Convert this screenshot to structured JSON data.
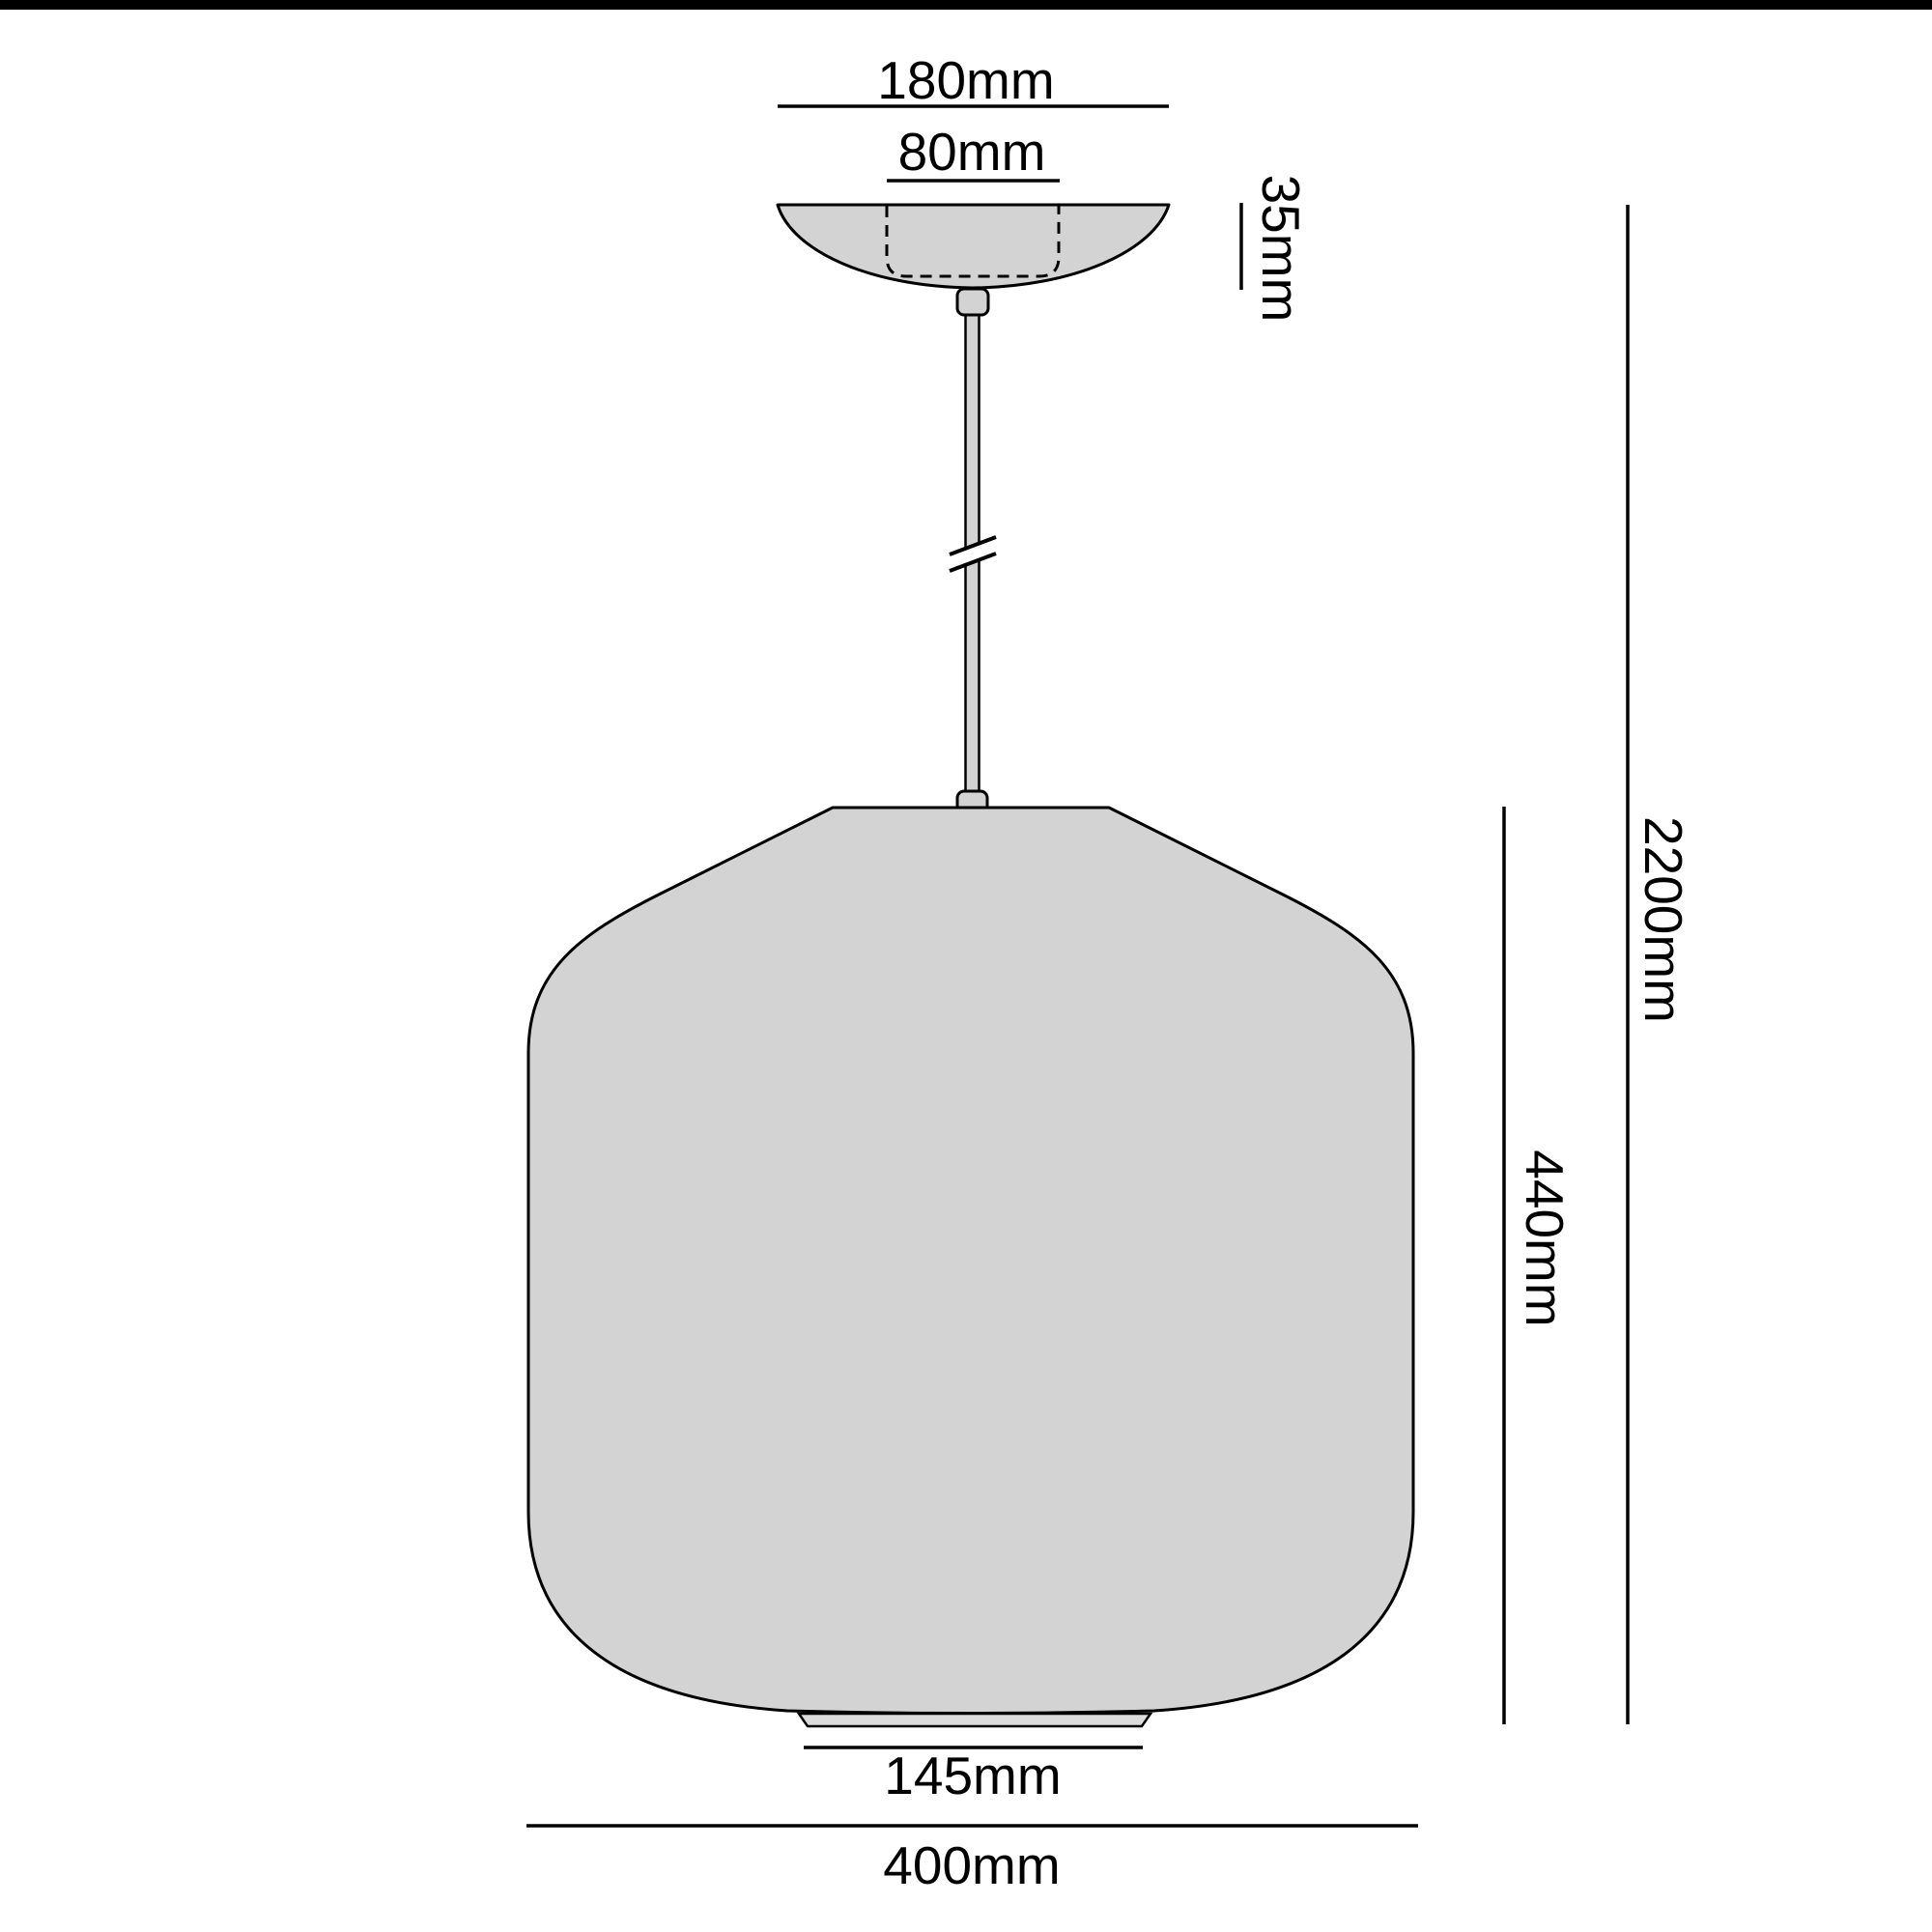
{
  "diagram": {
    "type": "pendant-lamp-dimension-drawing",
    "units": "mm",
    "colors": {
      "background": "#ffffff",
      "outline": "#000000",
      "shade_fill": "#d3d3d3",
      "ring_fill": "#dcdcdc",
      "rod_fill": "#d3d3d3",
      "top_bar": "#000000"
    },
    "labels": {
      "canopy_outer_width": "180mm",
      "canopy_inner_width": "80mm",
      "canopy_height": "35mm",
      "overall_drop": "2200mm",
      "shade_height": "440mm",
      "base_opening_width": "145mm",
      "shade_width": "400mm"
    },
    "dimensions_mm": {
      "canopy_outer_width": 180,
      "canopy_inner_width": 80,
      "canopy_height": 35,
      "overall_drop": 2200,
      "shade_height": 440,
      "base_opening_width": 145,
      "shade_width": 400
    }
  }
}
